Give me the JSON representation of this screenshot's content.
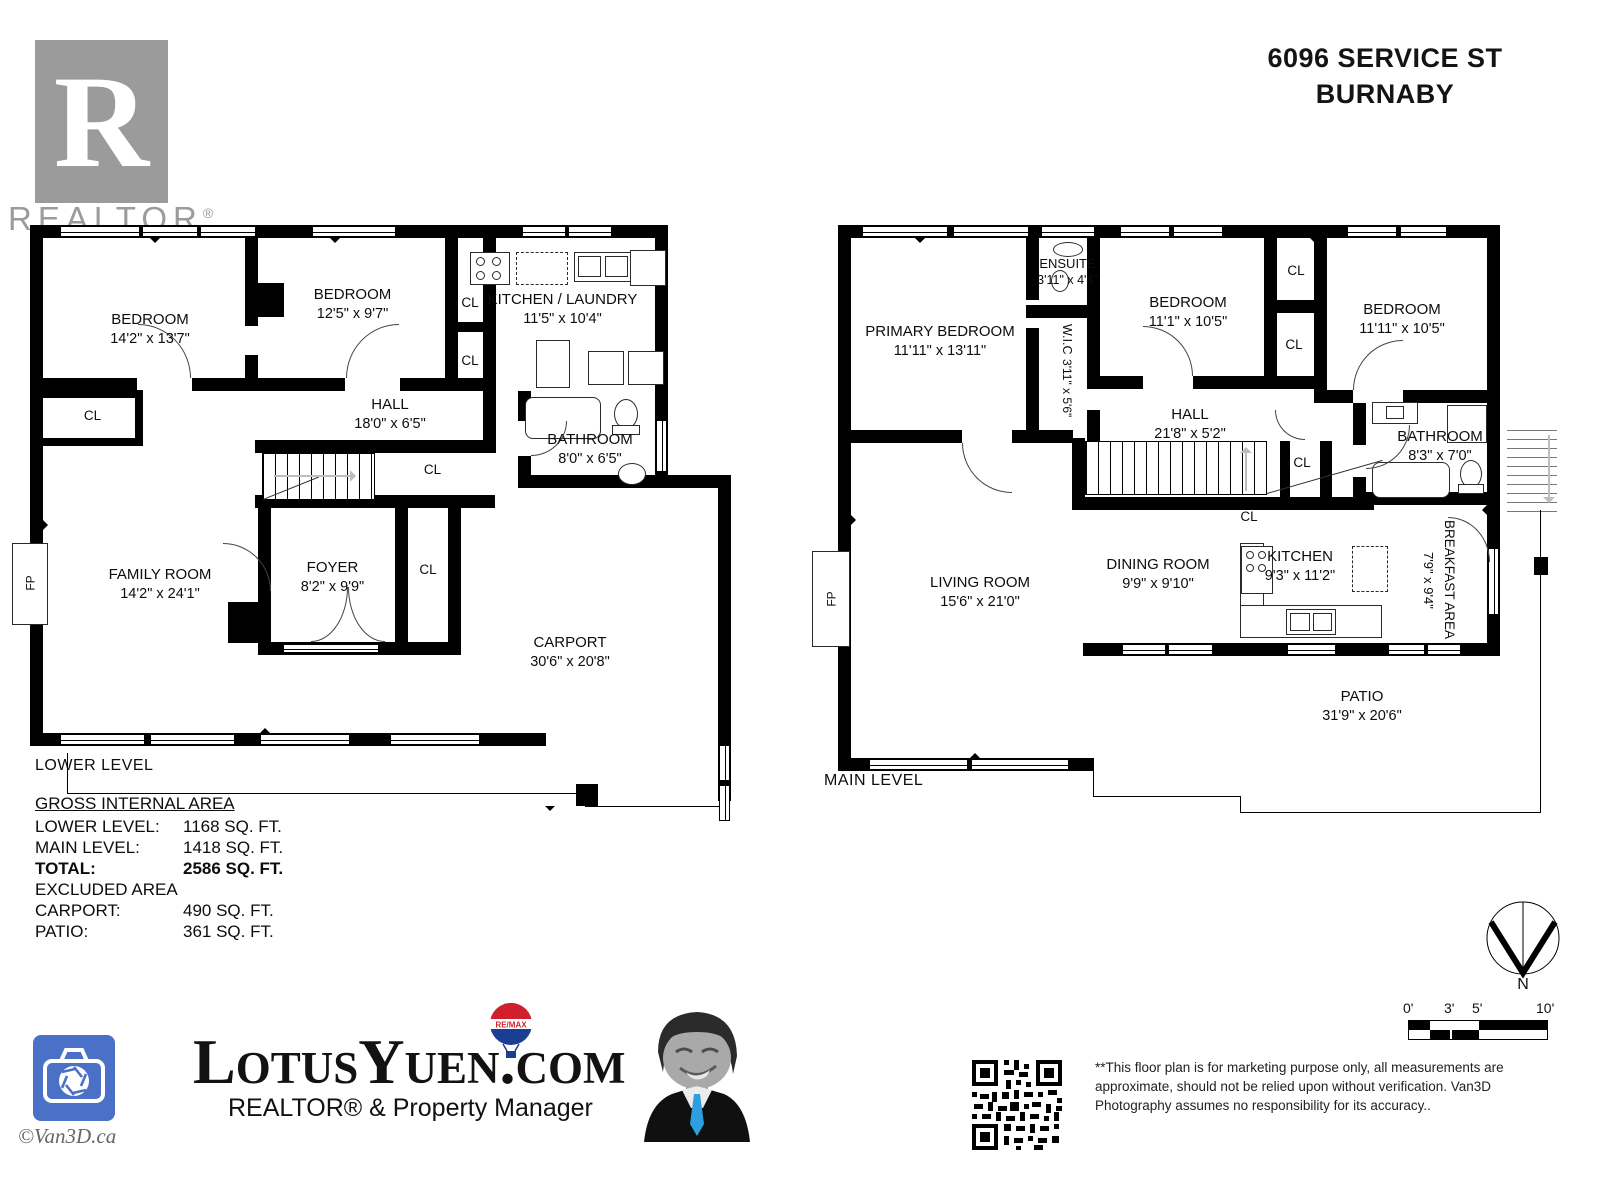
{
  "title": {
    "line1": "6096 SERVICE ST",
    "line2": "BURNABY"
  },
  "realtor_mark": {
    "letter": "R",
    "caption": "REALTOR",
    "reg": "®"
  },
  "plans": {
    "cl": "CL",
    "fp": "FP",
    "lower": {
      "caption": "LOWER LEVEL",
      "rooms": {
        "bedroom1": {
          "name": "BEDROOM",
          "dims": "14'2\" x 13'7\""
        },
        "bedroom2": {
          "name": "BEDROOM",
          "dims": "12'5\" x 9'7\""
        },
        "kitchen": {
          "name": "KITCHEN / LAUNDRY",
          "dims": "11'5\" x 10'4\""
        },
        "hall": {
          "name": "HALL",
          "dims": "18'0\" x 6'5\""
        },
        "bathroom": {
          "name": "BATHROOM",
          "dims": "8'0\" x 6'5\""
        },
        "family": {
          "name": "FAMILY ROOM",
          "dims": "14'2\" x 24'1\""
        },
        "foyer": {
          "name": "FOYER",
          "dims": "8'2\" x 9'9\""
        },
        "carport": {
          "name": "CARPORT",
          "dims": "30'6\" x 20'8\""
        }
      }
    },
    "main": {
      "caption": "MAIN LEVEL",
      "rooms": {
        "primary": {
          "name": "PRIMARY BEDROOM",
          "dims": "11'11\" x 13'11\""
        },
        "ensuite": {
          "name": "ENSUITE",
          "dims": "3'11\" x 4'4\""
        },
        "wic": {
          "name": "W.I.C",
          "dims": "3'11\" x 5'6\""
        },
        "bedroom2": {
          "name": "BEDROOM",
          "dims": "11'1\" x 10'5\""
        },
        "bedroom3": {
          "name": "BEDROOM",
          "dims": "11'11\" x 10'5\""
        },
        "hall": {
          "name": "HALL",
          "dims": "21'8\" x 5'2\""
        },
        "bathroom": {
          "name": "BATHROOM",
          "dims": "8'3\" x 7'0\""
        },
        "living": {
          "name": "LIVING ROOM",
          "dims": "15'6\" x 21'0\""
        },
        "dining": {
          "name": "DINING ROOM",
          "dims": "9'9\" x 9'10\""
        },
        "kitchen": {
          "name": "KITCHEN",
          "dims": "9'3\" x 11'2\""
        },
        "breakfast": {
          "name": "BREAKFAST AREA",
          "dims": "7'9\" x 9'4\""
        },
        "patio": {
          "name": "PATIO",
          "dims": "31'9\" x 20'6\""
        }
      }
    }
  },
  "areas": {
    "heading": "GROSS INTERNAL AREA",
    "rows": [
      {
        "label": "LOWER LEVEL:",
        "value": "1168 SQ. FT."
      },
      {
        "label": "MAIN LEVEL:",
        "value": "1418 SQ. FT."
      },
      {
        "label": "TOTAL:",
        "value": "2586 SQ. FT."
      },
      {
        "label": "EXCLUDED AREA",
        "value": ""
      },
      {
        "label": "CARPORT:",
        "value": "490 SQ. FT."
      },
      {
        "label": "PATIO:",
        "value": "361 SQ. FT."
      }
    ]
  },
  "compass": {
    "north": "N"
  },
  "scale_bar": {
    "ticks": [
      "0'",
      "3'",
      "5'",
      "10'"
    ]
  },
  "branding": {
    "camera_caption": "©Van3D.ca",
    "logo": {
      "part1": "Lotus",
      "part2": "Yuen",
      "part3": ".com"
    },
    "tagline": "REALTOR® & Property Manager",
    "remax": "RE/MAX"
  },
  "colors": {
    "accent_blue": "#4a70c8",
    "remax_red": "#d21f2c",
    "remax_blue": "#1b3e93",
    "tie_blue": "#2d9fe0",
    "logo_gray": "#9b9b9b"
  },
  "disclaimer": "**This floor plan is for marketing purpose only, all measurements are approximate, should not be relied upon without verification. Van3D Photography assumes no responsibility for its accuracy.."
}
